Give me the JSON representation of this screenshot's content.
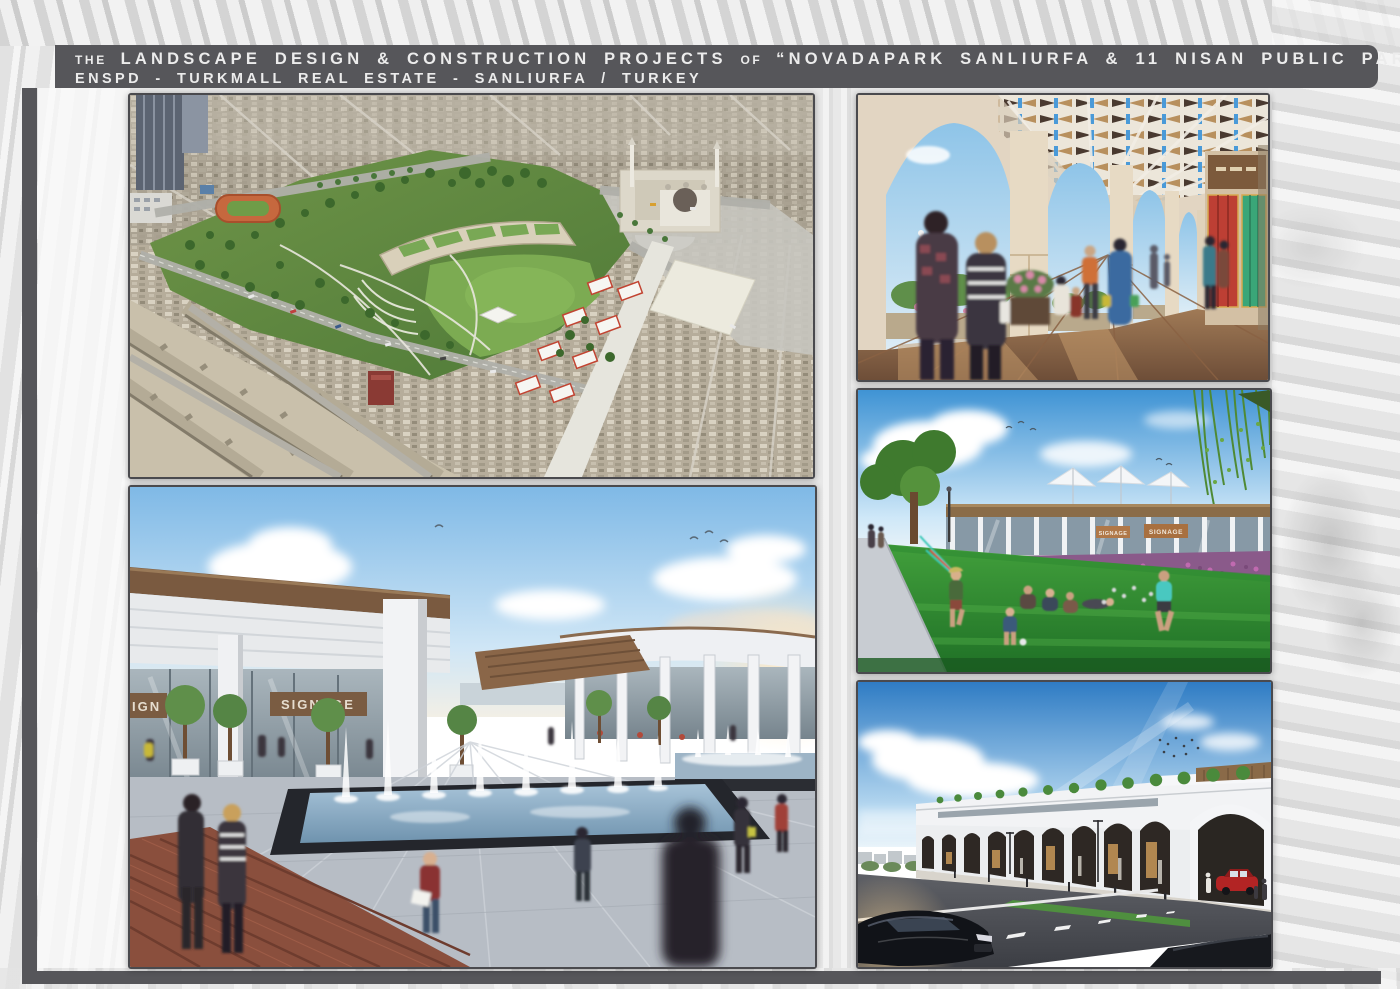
{
  "header": {
    "line1_the": "THE",
    "line1_main": "LANDSCAPE DESIGN & CONSTRUCTION PROJECTS",
    "line1_of": "OF",
    "line1_title": "“NOVADAPARK SANLIURFA & 11 NISAN PUBLIC PARK”",
    "line2": "ENSPD - TURKMALL REAL ESTATE - SANLIURFA / TURKEY",
    "bar_color": "#56565a",
    "text_color": "#ececec"
  },
  "frame": {
    "left_bar_color": "#56565a",
    "bottom_bar_color": "#56565a",
    "page_background": "#e9e9e9",
    "photo_border_color": "#4a4a4e"
  },
  "renderings": {
    "aerial": {
      "alt": "Aerial masterplan view of the public park with lawns, running track, terraced green-roof buildings, mosque with two minarets and market axis surrounded by dense city blocks"
    },
    "fountain": {
      "alt": "Plaza with dancing fountain pool, pergola covered shops and pedestrians",
      "signage_partial": "IGN",
      "signage": "SIGNAGE"
    },
    "arcade": {
      "alt": "Arched shopping arcade with patterned pergola ceiling, stone columns and shoppers"
    },
    "lawn": {
      "alt": "Park lawn with children playing in front of a glazed pavilion with sail canopies",
      "signage_a": "SIGNAGE",
      "signage_b": "SIGNAGE"
    },
    "street": {
      "alt": "Street elevation of the arched retail building with rooftop terrace trees and passing cars"
    }
  }
}
